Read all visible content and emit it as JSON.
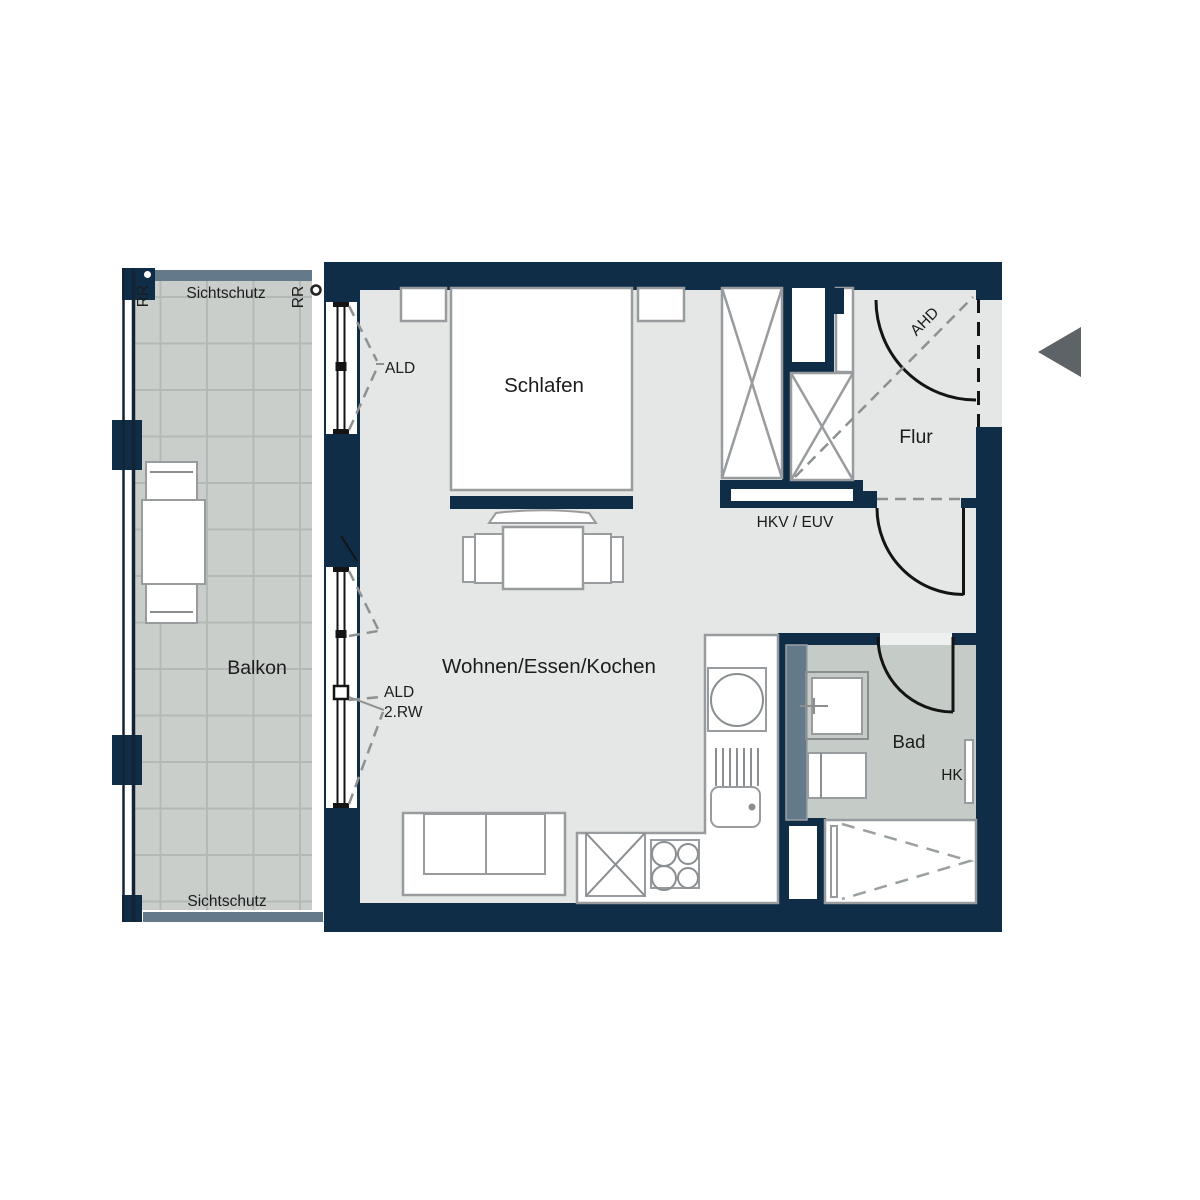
{
  "rooms": {
    "schlafen": "Schlafen",
    "wohnen": "Wohnen/Essen/Kochen",
    "flur": "Flur",
    "bad": "Bad",
    "balkon": "Balkon"
  },
  "labels": {
    "ald_top": "ALD",
    "ald_bottom_line1": "ALD",
    "ald_bottom_line2": "2.RW",
    "ahd": "AHD",
    "hkv_euv": "HKV / EUV",
    "hk": "HK",
    "sichtschutz_top": "Sichtschutz",
    "sichtschutz_bottom": "Sichtschutz",
    "rr_left": "RR",
    "rr_right": "RR"
  },
  "colors": {
    "wall": "#0f2d47",
    "floor": "#e5e6e6",
    "bath_floor": "#c5ccc8",
    "balcony_floor": "#c9cecb",
    "tile_line": "#b3b9b6",
    "screen": "#64798a",
    "furniture_outline": "#989c9e",
    "dash_gray": "#8c9192",
    "door_black": "#141414",
    "arrow": "#5d6366",
    "text": "#1c1c1c",
    "background": "#ffffff"
  }
}
